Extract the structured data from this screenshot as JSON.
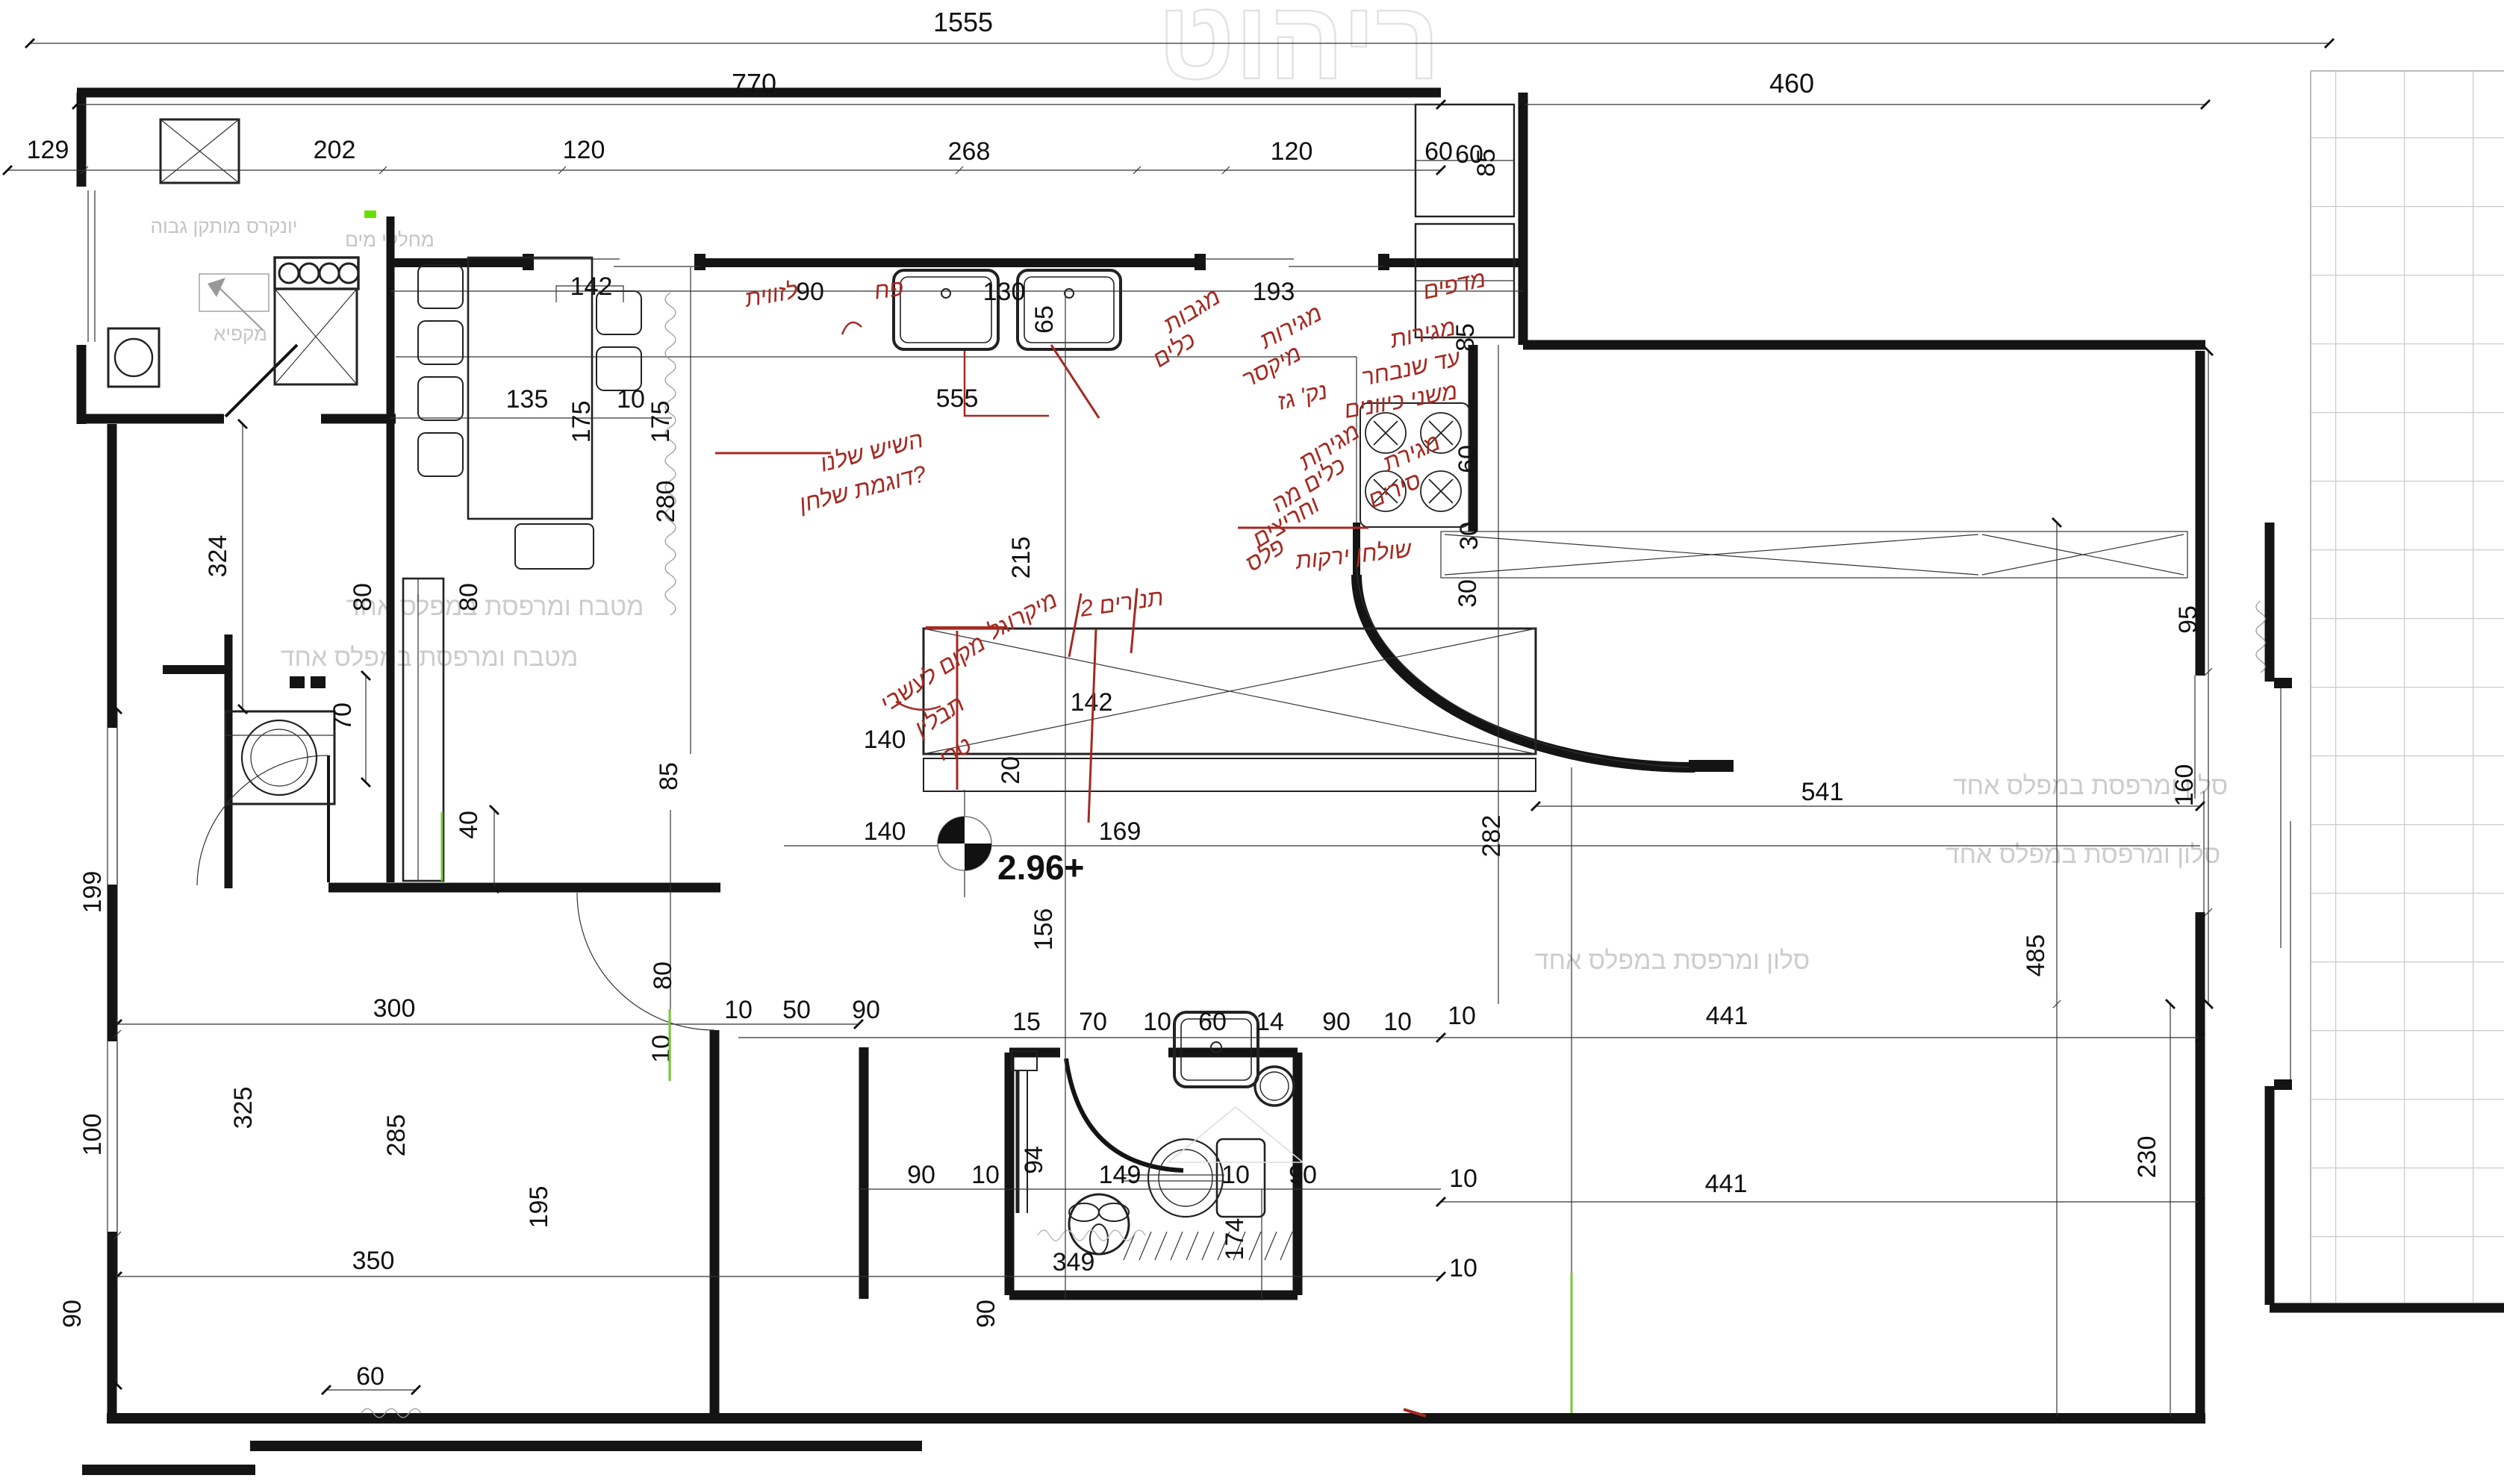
{
  "drawing": {
    "type": "architectural-floor-plan",
    "elevation_label": "2.96+",
    "colors": {
      "walls": "#141414",
      "red_notes": "#a42a22",
      "watermark": "#cccccc",
      "green_marks": "#76c832",
      "tiles": "#cbcbcb"
    },
    "dims": [
      "1555",
      "770",
      "460",
      "129",
      "202",
      "120",
      "268",
      "120",
      "60",
      "142",
      "90",
      "130",
      "65",
      "193",
      "555",
      "60",
      "85",
      "85",
      "135",
      "175",
      "10",
      "175",
      "324",
      "280",
      "215",
      "142",
      "140",
      "20",
      "140",
      "169",
      "282",
      "541",
      "156",
      "95",
      "160",
      "485",
      "230",
      "10",
      "441",
      "10",
      "441",
      "10",
      "199",
      "100",
      "90",
      "70",
      "80",
      "80",
      "40",
      "85",
      "80",
      "10",
      "300",
      "10",
      "50",
      "90",
      "15",
      "70",
      "10",
      "60",
      "14",
      "90",
      "10",
      "325",
      "285",
      "195",
      "350",
      "60",
      "90",
      "10",
      "149",
      "10",
      "90",
      "94",
      "349",
      "174",
      "90",
      "60",
      "30",
      "30"
    ],
    "red_notes": [
      "לזווית",
      "פח",
      "השיש שלנו",
      "דוגמת שלחן?",
      "מגבות",
      "כלים",
      "מגירות",
      "מיקסר",
      "מדפים",
      "מגירות",
      "כלים מה",
      "וחריצים",
      "פלס",
      "מגירות",
      "עד שנבחר",
      "משני כיוונים",
      "נק' גז",
      "מגירת",
      "סירים",
      "שולחן ירקות",
      "מיקרוגל",
      "2 תנורים",
      "מקום לעשבי",
      "תבלין",
      "טרי"
    ],
    "watermarks": [
      "יונקרס מותקן גבוה",
      "מחלקי מים",
      "מקפיא",
      "מטבח ומרפסת במפלס אחד",
      "מטבח ומרפסת במפלס אחד",
      "סלון ומרפסת במפלס אחד",
      "סלון ומרפסת במפלס אחד",
      "סלון ומרפסת במפלס אחד",
      "ריהוט"
    ]
  }
}
